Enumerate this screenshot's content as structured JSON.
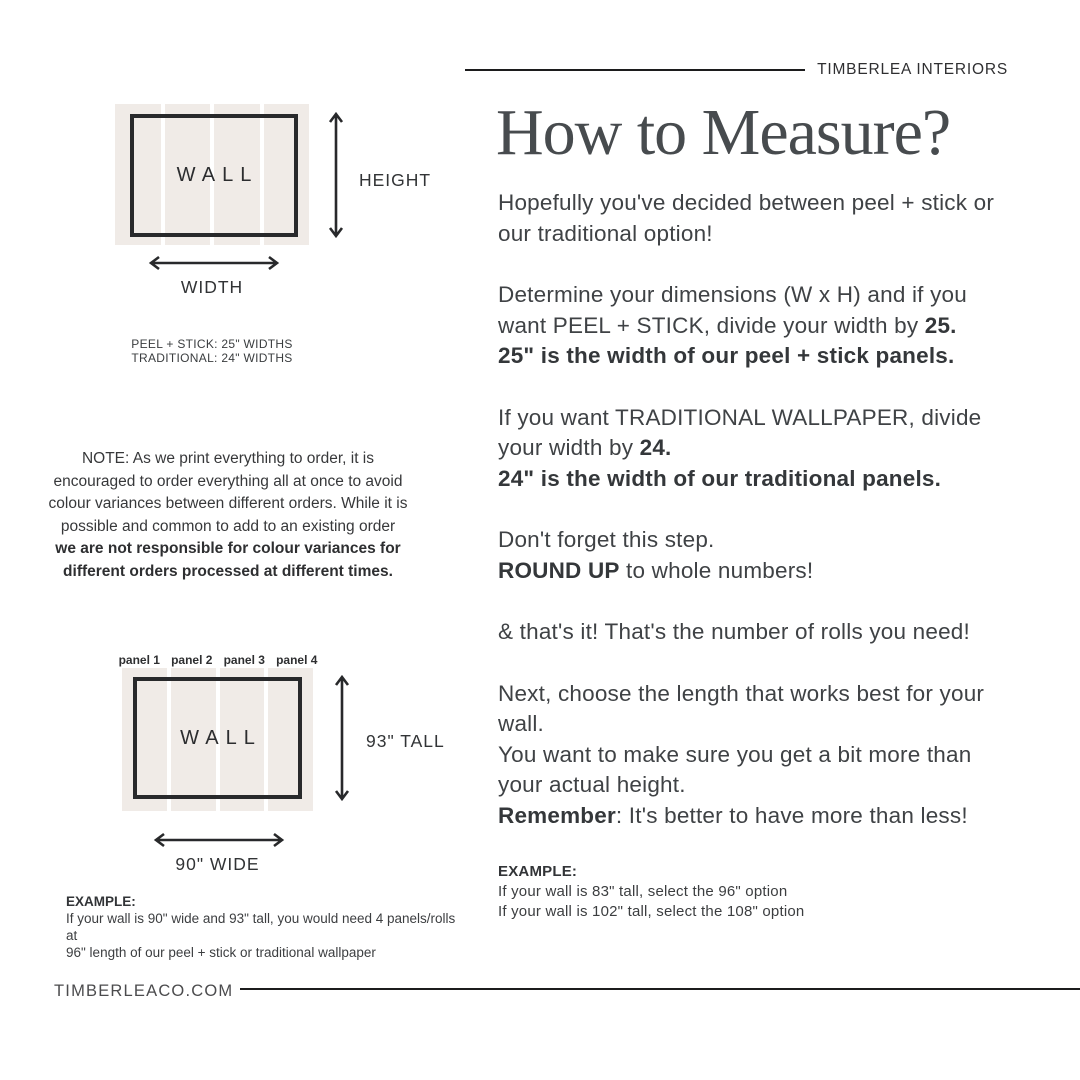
{
  "colors": {
    "panel_beige": "#f0ebe7",
    "ink": "#3f4245",
    "rule": "#1c1c1d"
  },
  "header": {
    "brand": "TIMBERLEA INTERIORS"
  },
  "title": "How to Measure?",
  "left": {
    "diagram1": {
      "wall_label": "WALL",
      "height_label": "HEIGHT",
      "width_label": "WIDTH"
    },
    "widths_note": {
      "line1": "PEEL + STICK: 25\" WIDTHS",
      "line2": "TRADITIONAL: 24\" WIDTHS"
    },
    "note": {
      "regular_lines": [
        "NOTE: As we print everything to order, it is",
        "encouraged to order everything all at once to avoid",
        "colour variances between different orders. While it is",
        "possible and common to add to an existing order"
      ],
      "bold_lines": [
        "we are not responsible for colour variances for",
        "different orders processed at different times."
      ]
    },
    "diagram2": {
      "panels": [
        "panel 1",
        "panel 2",
        "panel 3",
        "panel 4"
      ],
      "wall_label": "WALL",
      "tall_label": "93\" TALL",
      "wide_label": "90\" WIDE"
    },
    "example": {
      "heading": "EXAMPLE:",
      "line1": "If your wall is 90\" wide and 93\" tall, you would need 4 panels/rolls at",
      "line2": "96\" length of our peel + stick or traditional wallpaper"
    }
  },
  "right": {
    "p1": "Hopefully you've decided between peel + stick or our traditional option!",
    "p2a": "Determine your dimensions (W x H) and if you want PEEL + STICK, divide your width by ",
    "p2b": "25.",
    "p2c": "25\" is the width of our peel + stick panels.",
    "p3a": "If you want TRADITIONAL WALLPAPER, divide your width by ",
    "p3b": "24.",
    "p3c": "24\" is the width of our traditional panels.",
    "p4a": "Don't forget this step.",
    "p4b": "ROUND UP",
    "p4c": " to whole numbers!",
    "p5": "& that's it! That's the number of rolls you need!",
    "p6a": "Next, choose the length that works best for your wall.",
    "p6b": "You want to make sure you get a bit more than your actual height.",
    "p6c": "Remember",
    "p6d": ": It's better to have more than less!",
    "example": {
      "heading": "EXAMPLE:",
      "line1": "If your wall is 83\" tall, select the 96\" option",
      "line2": "If your wall is 102\" tall, select the 108\" option"
    }
  },
  "footer": {
    "site": "TIMBERLEACO.COM"
  }
}
